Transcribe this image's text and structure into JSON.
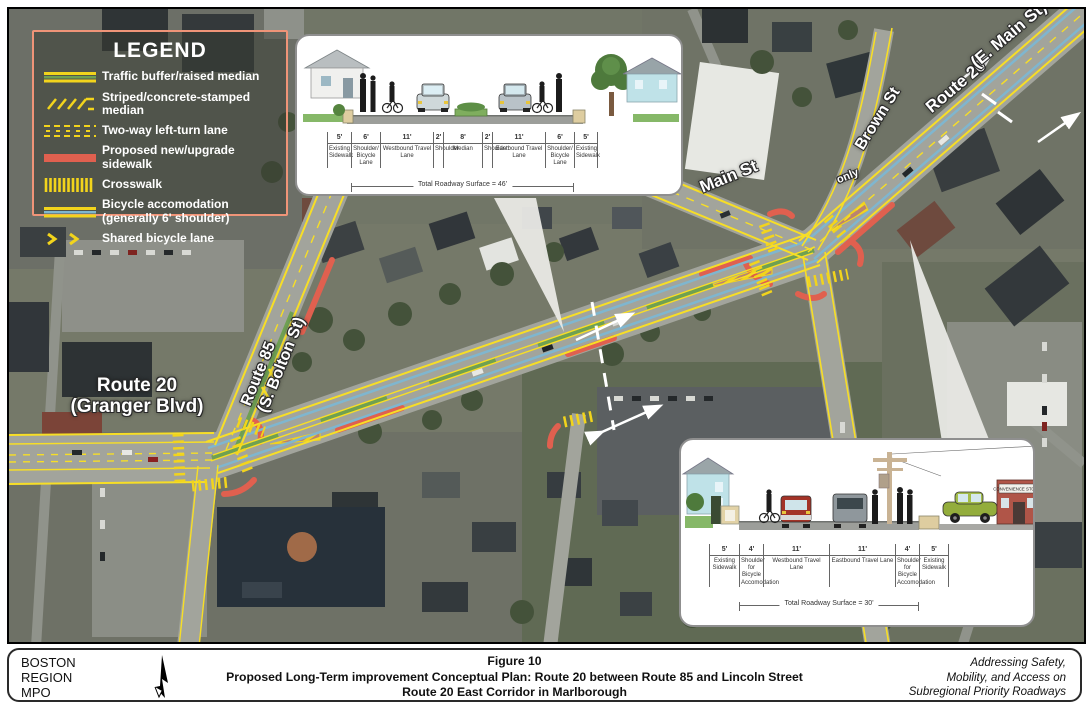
{
  "legend": {
    "title": "LEGEND",
    "items": [
      {
        "label": "Traffic buffer/raised median"
      },
      {
        "label": "Striped/concrete-stamped median"
      },
      {
        "label": "Two-way left-turn lane"
      },
      {
        "label": "Proposed new/upgrade sidewalk"
      },
      {
        "label": "Crosswalk"
      },
      {
        "label": "Bicycle accomodation\n(generally 6' shoulder)"
      },
      {
        "label": "Shared bicycle lane"
      }
    ]
  },
  "map_labels": {
    "granger": "Route 20\n(Granger Blvd)",
    "route85": "Route 85\n(S. Bolton St)",
    "main_st": "Main St",
    "only": "only",
    "brown_st": "Brown St",
    "emain_route": "Route 20",
    "emain_name": "(E. Main St)"
  },
  "cross_sections": {
    "top": {
      "segments": [
        {
          "dim": "5'",
          "label": "Existing Sidewalk"
        },
        {
          "dim": "6'",
          "label": "Shoulder/ Bicycle Lane"
        },
        {
          "dim": "11'",
          "label": "Westbound Travel Lane"
        },
        {
          "dim": "2'",
          "label": "Shoulder"
        },
        {
          "dim": "8'",
          "label": "Median"
        },
        {
          "dim": "2'",
          "label": "Shoulder"
        },
        {
          "dim": "11'",
          "label": "Eastbound Travel Lane"
        },
        {
          "dim": "6'",
          "label": "Shoulder/ Bicycle Lane"
        },
        {
          "dim": "5'",
          "label": "Existing Sidewalk"
        }
      ],
      "total": "Total Roadway Surface = 46'"
    },
    "bottom": {
      "segments": [
        {
          "dim": "5'",
          "label": "Existing Sidewalk"
        },
        {
          "dim": "4'",
          "label": "Shoulder for Bicycle Accomodation"
        },
        {
          "dim": "11'",
          "label": "Westbound Travel Lane"
        },
        {
          "dim": "11'",
          "label": "Eastbound Travel Lane"
        },
        {
          "dim": "4'",
          "label": "Shoulder for Bicycle Accomodation"
        },
        {
          "dim": "5'",
          "label": "Existing Sidewalk"
        }
      ],
      "total": "Total Roadway Surface = 30'",
      "sign": "CONVENIENCE STORE"
    }
  },
  "title_block": {
    "org": "BOSTON\nREGION\nMPO",
    "figure": "Figure 10",
    "line1": "Proposed Long-Term improvement Conceptual Plan: Route 20 between Route 85 and Lincoln Street",
    "line2": "Route 20 East Corridor in Marlborough",
    "tagline": "Addressing Safety,\nMobility, and Access on\nSubregional Priority Roadways"
  },
  "colors": {
    "overlay_yellow": "#f2d41c",
    "bike_blue": "#7fb6cf",
    "sidewalk_red": "#e0604f",
    "median_green": "#6fa052",
    "legend_border": "#ef9478"
  }
}
